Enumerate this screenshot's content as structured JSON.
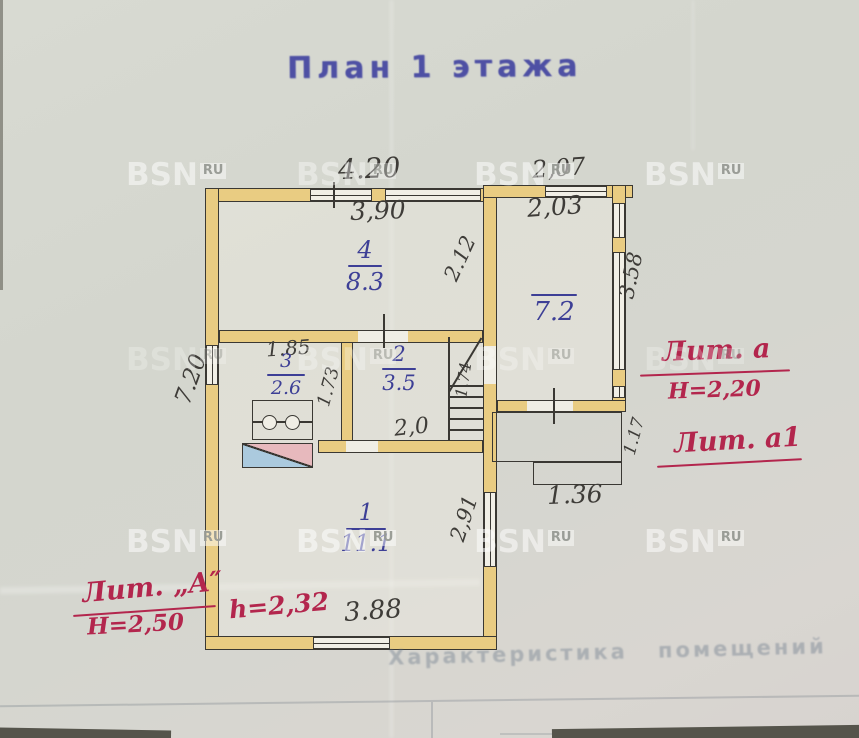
{
  "title": "План 1 этажа",
  "watermark": {
    "text": "BSN",
    "suffix": "RU"
  },
  "colors": {
    "paper": "#d5d7cf",
    "ink": "#3e3c38",
    "blue_ink": "#3d3f96",
    "red_ink": "#b3264d",
    "stamp_blue": "#4e50a4",
    "wall_fill": "#e9cc82",
    "wall_line": "#3a3833",
    "stove_blue": "#abcade",
    "stove_pink": "#e7b9bd"
  },
  "rooms": {
    "room4": {
      "number": "4",
      "area": "8.3"
    },
    "room3": {
      "number": "3",
      "area": "2.6"
    },
    "room2": {
      "number": "2",
      "area": "3.5"
    },
    "room1": {
      "number": "1",
      "area": "11.1"
    },
    "veranda": {
      "area": "7.2"
    }
  },
  "dimensions": {
    "main_top_outer": "4.20",
    "main_top_inner": "3,90",
    "veranda_top_outer": "2,07",
    "veranda_top_inner": "2,03",
    "room4_height": "2.12",
    "veranda_right": "3.58",
    "main_left": "7.20",
    "room3_width": "1.85",
    "room3_height": "1.73",
    "stair_width": "1.74",
    "room2_width": "2,0",
    "porch_width": "1.36",
    "porch_height": "1.17",
    "room1_height": "2,91",
    "room1_width": "3.88"
  },
  "annotations": {
    "liter_main": "Лит. „А″",
    "height_main": "Н=2,50",
    "ceiling_room1": "h=2,32",
    "liter_veranda": "Лит. а",
    "height_veranda": "Н=2,20",
    "liter_porch": "Лит. а1"
  },
  "bleed_through_text": "Характеристика помещений"
}
